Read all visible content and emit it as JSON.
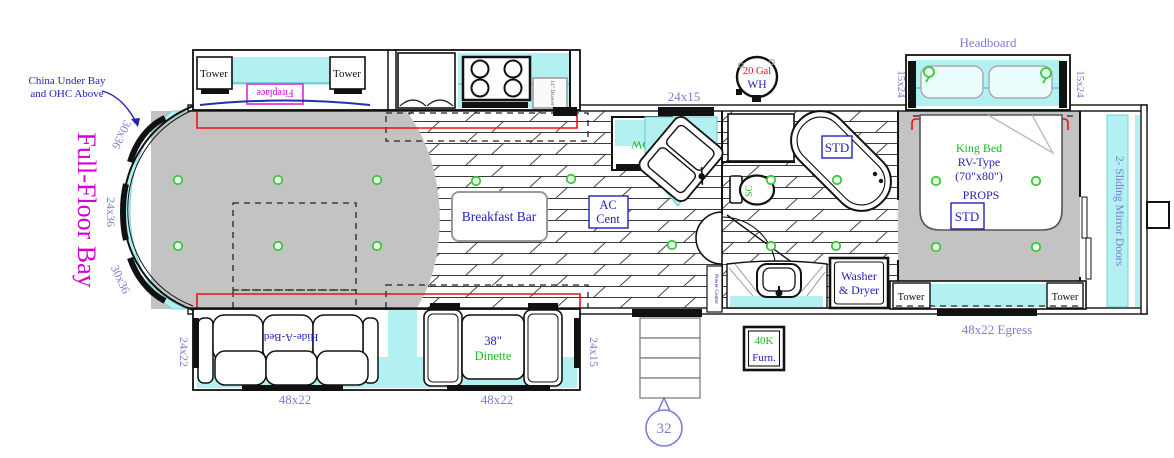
{
  "title": "RV Fifth-Wheel Floor Plan",
  "colors": {
    "counter_cyan": "#b2f0f2",
    "carpet_gray": "#c3c3c3",
    "dim_label_blue": "#7d7dd0",
    "callout_blue": "#2222bb",
    "feature_green": "#1db81d",
    "warning_red": "#dd1111",
    "accent_magenta": "#d400d4",
    "slide_seal_red": "#ee1111"
  },
  "labels": {
    "china_bay_1": "China Under Bay",
    "china_bay_2": "and OHC Above",
    "full_floor_bay": "Full-Floor Bay",
    "tower": "Tower",
    "fireplace": "Fireplace",
    "dim_30x36": "30x36",
    "dim_24x36": "24x36",
    "dim_24x22": "24x22",
    "dim_48x22": "48x22",
    "dim_24x15": "24x15",
    "dim_15x24": "15x24",
    "egress": "48x22 Egress",
    "headboard": "Headboard",
    "hide_a_bed": "Hide-A-Bed",
    "dinette_size": "38\"",
    "dinette": "Dinette",
    "breakfast_bar": "Breakfast Bar",
    "ac_1": "AC",
    "ac_2": "Cent",
    "dw": "DW",
    "sc": "SC",
    "wh_1": "20 Gal",
    "wh_2": "WH",
    "std": "STD",
    "king_1": "King Bed",
    "king_2": "RV-Type",
    "king_3": "(70\"x80\")",
    "king_4": "PROPS",
    "sliding_doors": "2- Sliding Mirror Doors",
    "washer_1": "Washer",
    "washer_2": "& Dryer",
    "furnace_1": "40K",
    "furnace_2": "Furn.",
    "power_center": "Power Center",
    "drawer": "14\" Drawer",
    "callout": "32"
  }
}
